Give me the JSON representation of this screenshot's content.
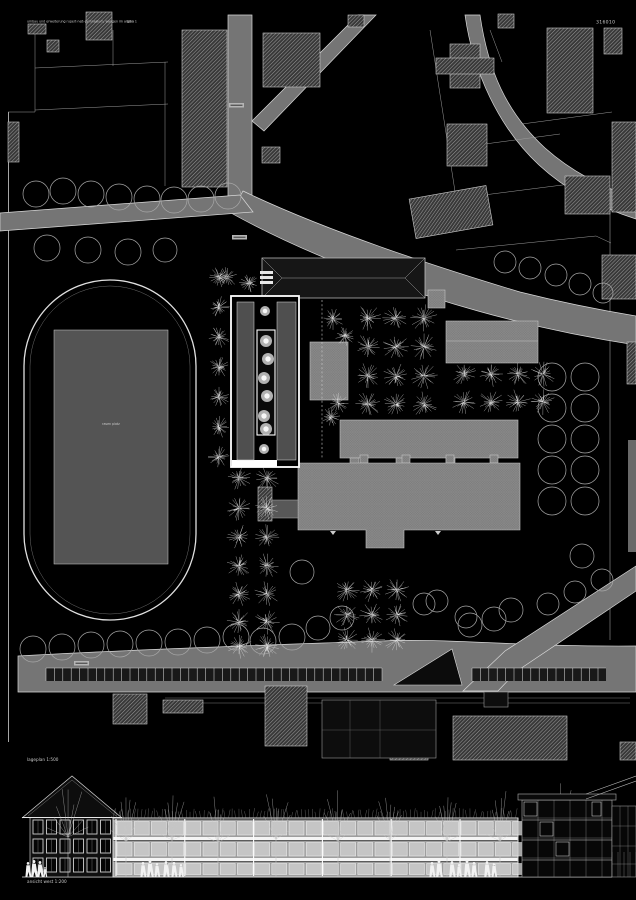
{
  "poster": {
    "title": "umbau und erweiterung rupert-neß-gymnasium, wangen im allgäu",
    "plan_label": "plan 1",
    "entry_code": "316010"
  },
  "site_plan": {
    "caption": "lageplan 1:500",
    "field_label": "rasen platz"
  },
  "elevation": {
    "caption": "ansicht west 1:200"
  },
  "colors": {
    "background": "#000000",
    "road": "#757575",
    "hatched_building_line": "#9d9d9d",
    "school_building": "#7d7d7d",
    "new_building_highlight": "#ffffff",
    "tree_outline": "#a8a8a8",
    "drawing_line": "#cccccc"
  }
}
